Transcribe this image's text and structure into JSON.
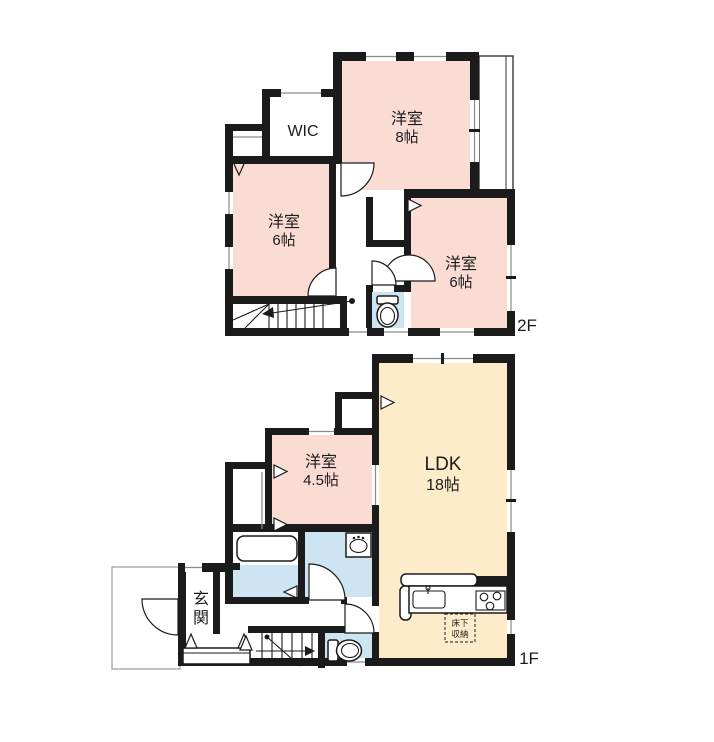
{
  "floor2": {
    "label": "2F",
    "rooms": {
      "bedroom8": {
        "name": "洋室",
        "size": "8帖"
      },
      "wic": {
        "name": "WIC"
      },
      "bedroom6_left": {
        "name": "洋室",
        "size": "6帖"
      },
      "bedroom6_right": {
        "name": "洋室",
        "size": "6帖"
      }
    }
  },
  "floor1": {
    "label": "1F",
    "rooms": {
      "ldk": {
        "name": "LDK",
        "size": "18帖"
      },
      "bedroom45": {
        "name": "洋室",
        "size": "4.5帖"
      },
      "genkan": {
        "char1": "玄",
        "char2": "関"
      },
      "underfloor_storage": {
        "line1": "床下",
        "line2": "収納"
      }
    }
  },
  "colors": {
    "wall": "#1b1b1b",
    "room_pink": "#fadcd3",
    "ldk_cream": "#fdecc9",
    "wet_blue": "#cde5f2"
  }
}
